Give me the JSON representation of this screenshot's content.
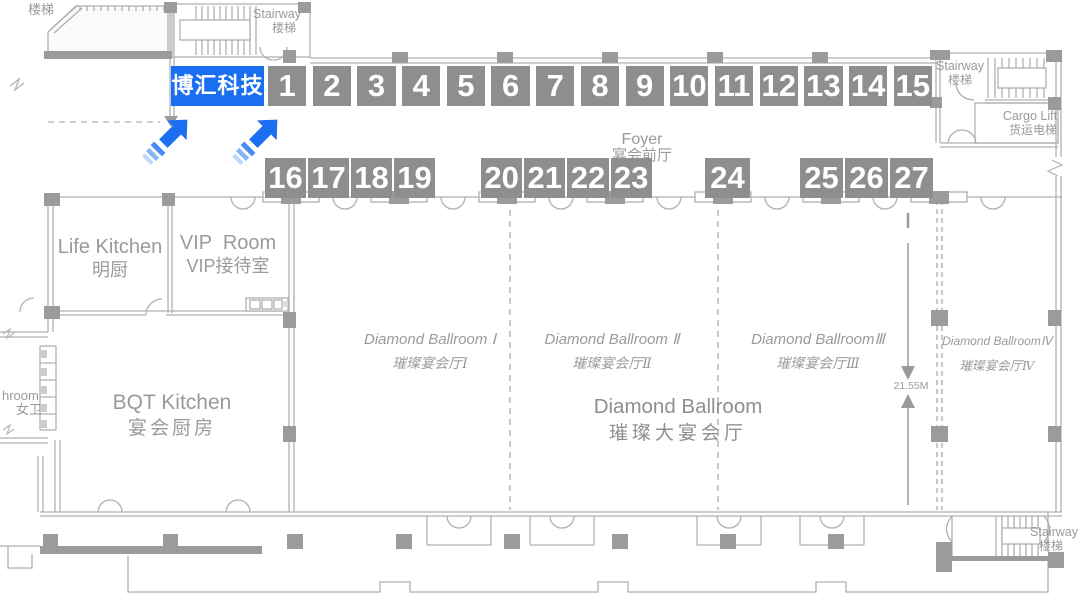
{
  "colors": {
    "accent_blue": "#1a6ef2",
    "booth_gray": "#8e8e8e",
    "line_gray": "#b0b0b0",
    "wall_gray": "#9b9b9b",
    "label_gray": "#9a9a9a",
    "white": "#ffffff"
  },
  "brand": {
    "label": "博汇科技"
  },
  "booths": {
    "row1": [
      "1",
      "2",
      "3",
      "4",
      "5",
      "6",
      "7",
      "8",
      "9",
      "10",
      "11",
      "12",
      "13",
      "14",
      "15"
    ],
    "g1": [
      "16",
      "17",
      "18",
      "19"
    ],
    "g2": [
      "20",
      "21",
      "22",
      "23"
    ],
    "g3": [
      "24"
    ],
    "g4": [
      "25",
      "26",
      "27"
    ]
  },
  "foyer": {
    "en": "Foyer",
    "zh": "宴会前厅"
  },
  "rooms": {
    "life_kitchen": {
      "en": "Life Kitchen",
      "zh": "明厨"
    },
    "vip_room": {
      "en": "VIP  Room",
      "zh": "VIP接待室"
    },
    "bqt_kitchen": {
      "en": "BQT Kitchen",
      "zh": "宴会厨房"
    },
    "washroom": {
      "en": "hroom",
      "zh": "女卫"
    },
    "cargo_lift": {
      "en": "Cargo Lift",
      "zh": "货运电梯"
    },
    "ballroom_1": {
      "en": "Diamond Ballroom Ⅰ",
      "zh": "璀璨宴会厅Ⅰ"
    },
    "ballroom_2": {
      "en": "Diamond Ballroom Ⅱ",
      "zh": "璀璨宴会厅Ⅱ"
    },
    "ballroom_3": {
      "en": "Diamond BallroomⅢ",
      "zh": "璀璨宴会厅Ⅲ"
    },
    "ballroom_4": {
      "en": "Diamond BallroomⅣ",
      "zh": "璀璨宴会厅Ⅳ"
    },
    "main_ballroom": {
      "en": "Diamond Ballroom",
      "zh": "璀璨大宴会厅"
    }
  },
  "stairs": {
    "top_left": {
      "zh": "楼梯"
    },
    "top": {
      "en": "Stairway",
      "zh": "楼梯"
    },
    "top_right": {
      "en": "Stairway",
      "zh": "楼梯"
    },
    "bottom_right": {
      "en": "Stairway",
      "zh": "楼梯"
    }
  },
  "dimension": {
    "value": "21.55M"
  }
}
